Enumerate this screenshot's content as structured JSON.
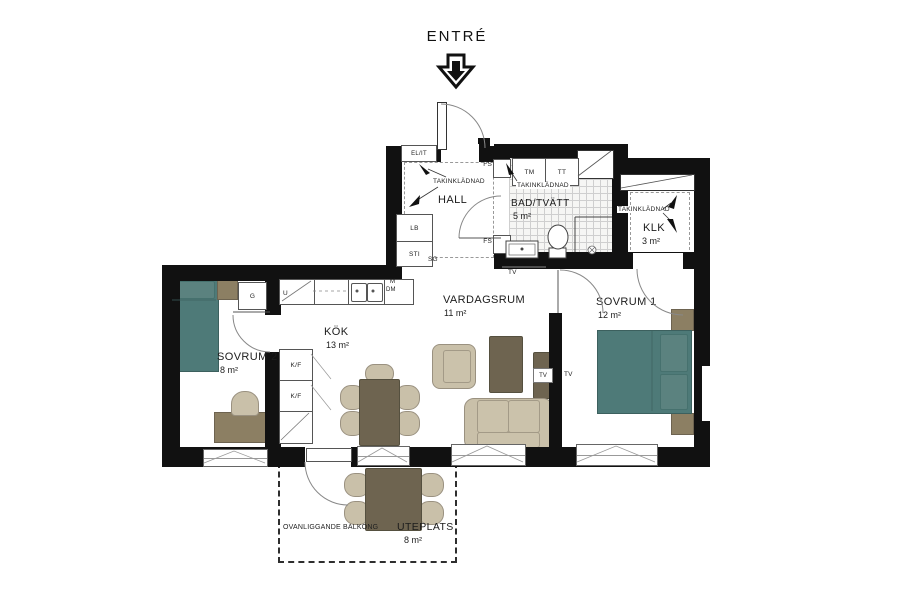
{
  "plan": {
    "entry_label": "ENTRÉ",
    "rooms": {
      "hall": {
        "name": "HALL"
      },
      "bath": {
        "name": "BAD/TVÄTT",
        "area": "5 m²"
      },
      "closet": {
        "name": "KLK",
        "area": "3 m²"
      },
      "bedroom1": {
        "name": "SOVRUM 1",
        "area": "12 m²"
      },
      "living": {
        "name": "VARDAGSRUM",
        "area": "11 m²"
      },
      "kitchen": {
        "name": "KÖK",
        "area": "13 m²"
      },
      "bedroom2": {
        "name": "SOVRUM 2",
        "area": "8 m²"
      },
      "patio": {
        "name": "UTEPLATS",
        "area": "8 m²"
      }
    },
    "annotations": {
      "balcony_above": "OVANLIGGANDE BALKONG",
      "ceiling_cladding": "TAKINKLÄDNAD",
      "el_it": "EL/IT",
      "fs": "FS",
      "washer": "TM",
      "dryer": "TT",
      "lb": "LB",
      "sti": "STI",
      "sg": "SG",
      "micro": "M",
      "dishwasher": "DM",
      "wardrobe": "G",
      "corner_unit": "U",
      "fridge_freezer": "K/F",
      "tv": "TV"
    },
    "colors": {
      "wall": "#111111",
      "bed_teal": "#4e7a78",
      "wood_dark": "#6e6450",
      "wood_light": "#8c7f63",
      "upholstery": "#c9c0a9",
      "tile_line": "#cfcfcf"
    }
  }
}
